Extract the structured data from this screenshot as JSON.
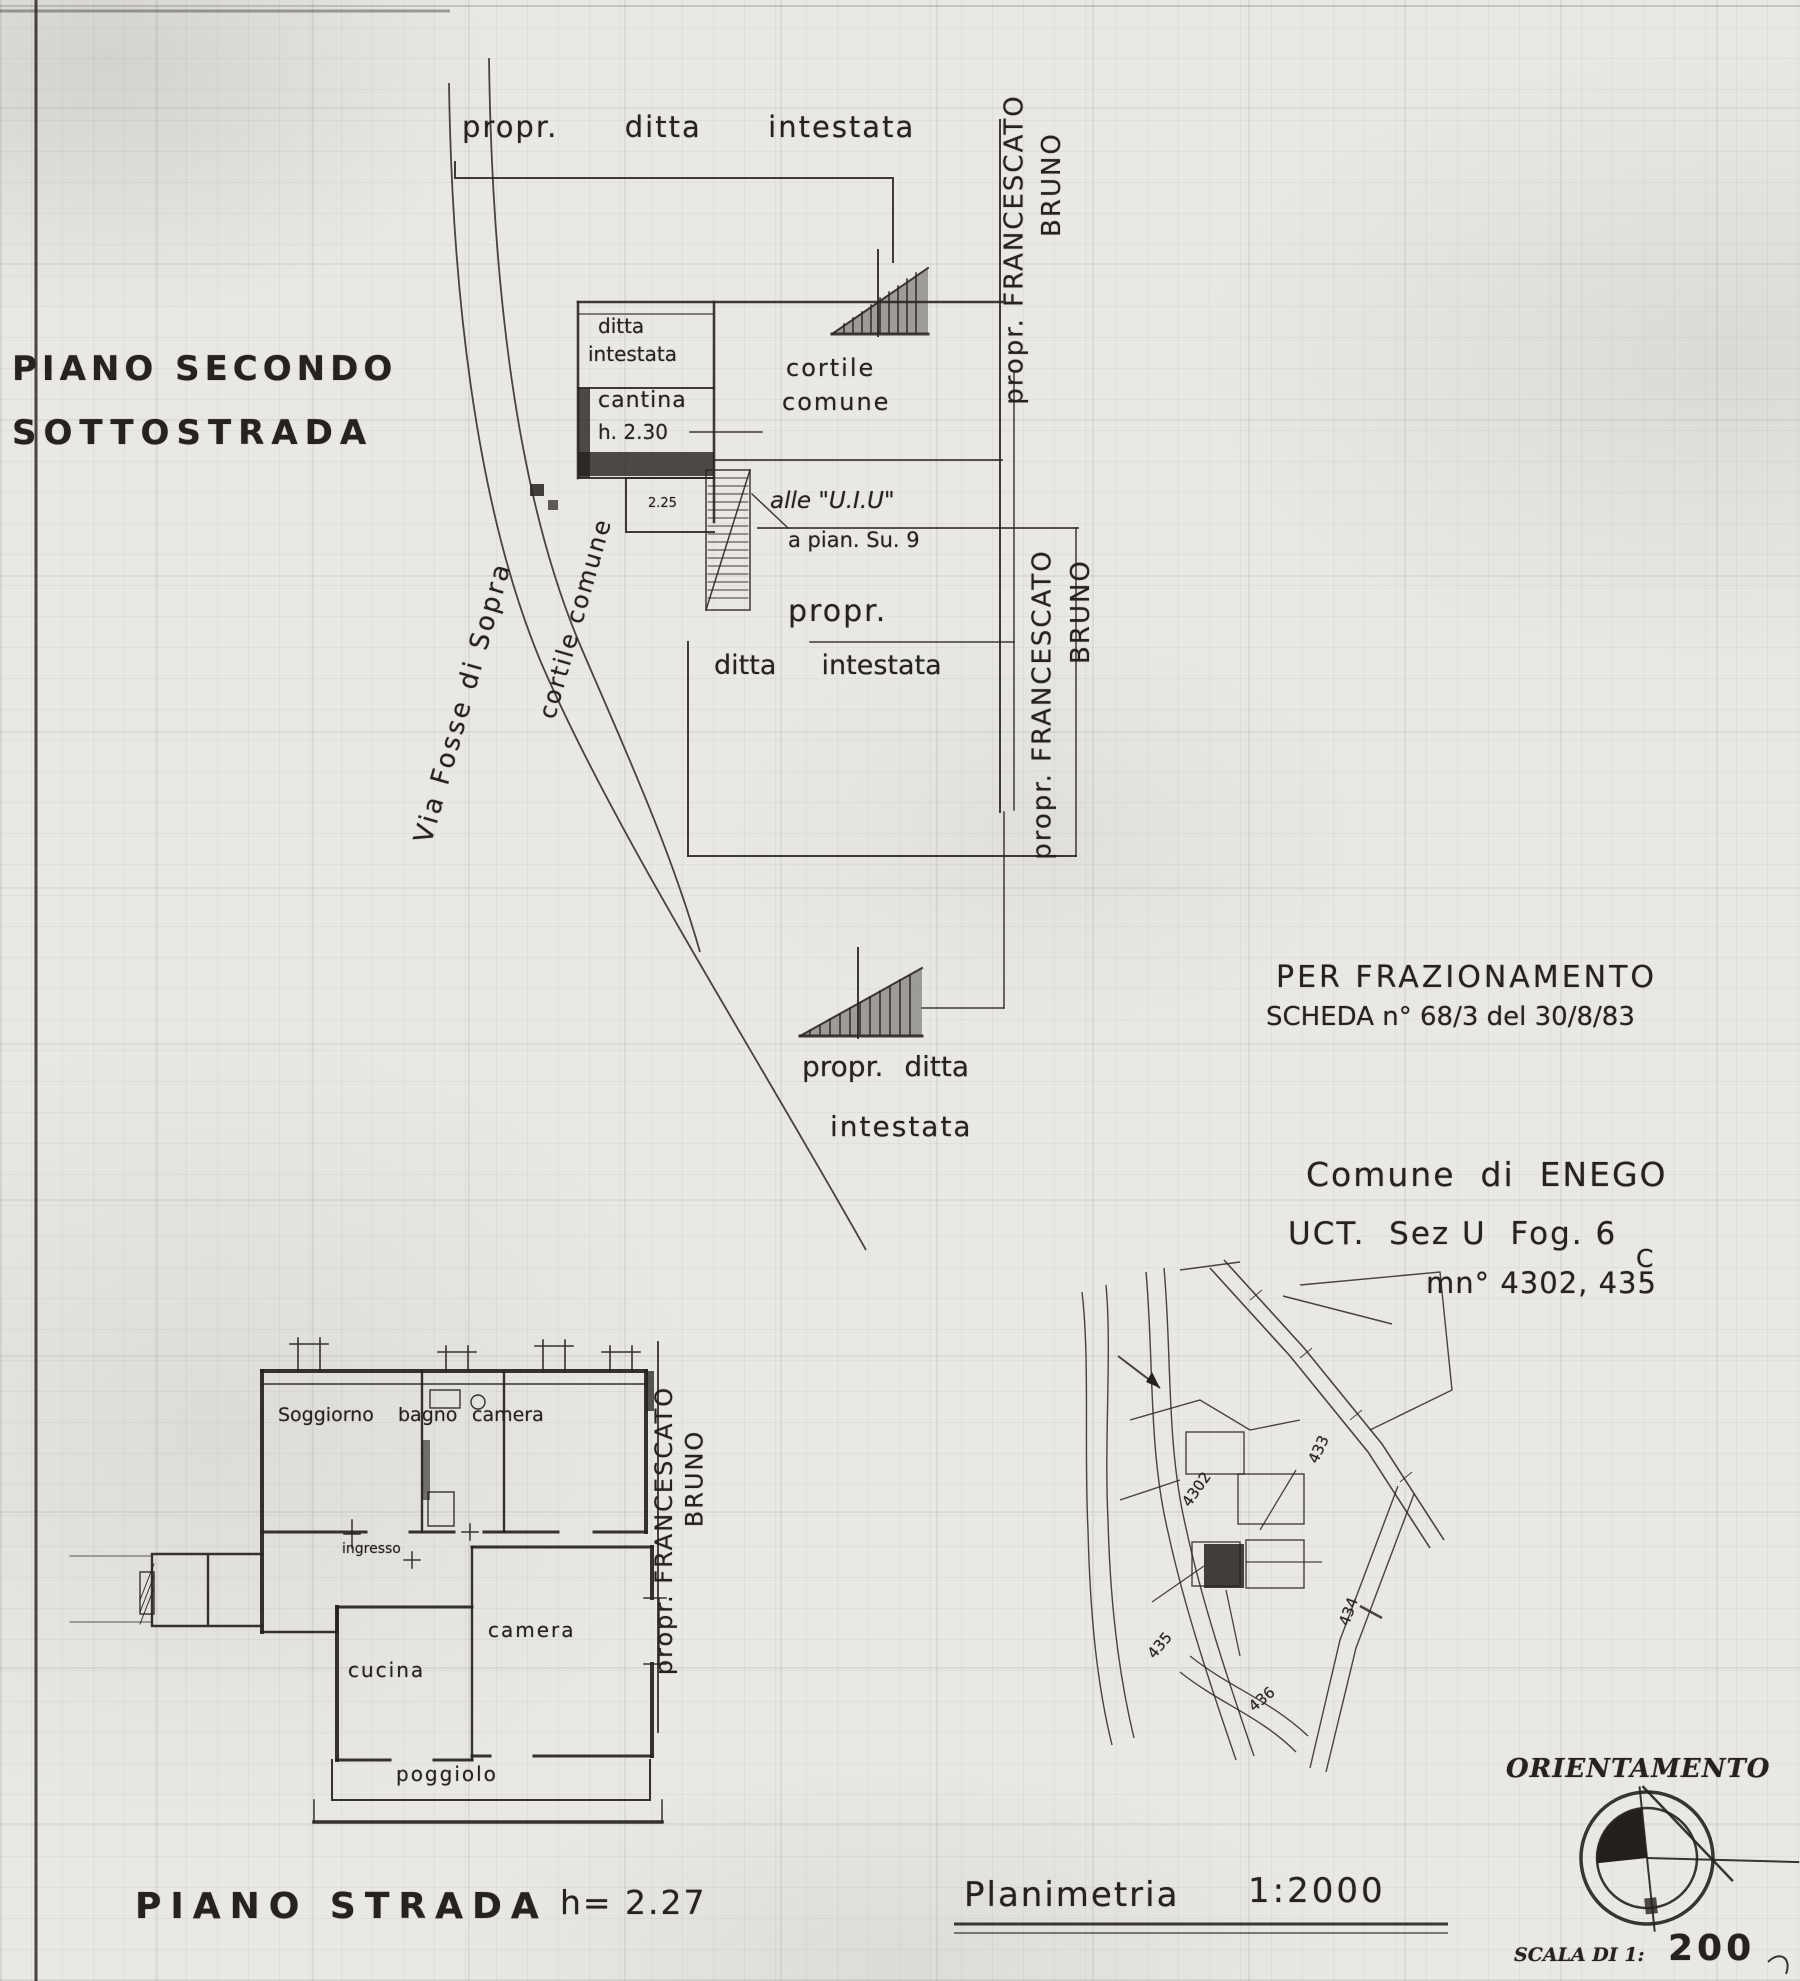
{
  "floor2": {
    "title_line1": "PIANO SECONDO",
    "title_line2": "SOTTOSTRADA",
    "owner_top": "propr.  ditta  intestata",
    "cantina_owner_line1": "ditta",
    "cantina_owner_line2": "intestata",
    "cantina_label": "cantina",
    "cantina_height": "h. 2.30",
    "passage_height": "2.25",
    "cortile_line1": "cortile",
    "cortile_line2": "comune",
    "uiu_line1": "alle \"U.I.U\"",
    "uiu_line2": "a pian. Su. 9",
    "owner_mid_line1": "propr.",
    "owner_mid_line2": "ditta  intestata",
    "owner_stairs_line1": "propr. ditta",
    "owner_stairs_line2": "intestata",
    "street": "Via Fosse di Sopra",
    "cortile_diag": "cortile comune",
    "neighbor_line1": "propr. FRANCESCATO",
    "neighbor_line2": "BRUNO"
  },
  "floor1": {
    "caption": "PIANO STRADA",
    "height": "h= 2.27",
    "rooms": {
      "soggiorno": "Soggiorno",
      "bagno": "bagno",
      "camera1": "camera",
      "ingresso": "ingresso",
      "cucina": "cucina",
      "camera2": "camera",
      "poggiolo": "poggiolo"
    },
    "neighbor_line1": "propr. FRANCESCATO",
    "neighbor_line2": "BRUNO"
  },
  "notes": {
    "fraz_line1": "PER FRAZIONAMENTO",
    "fraz_line2": "SCHEDA n° 68/3 del 30/8/83",
    "comune_line1": "Comune  di  ENEGO",
    "comune_line2": "UCT.  Sez U  Fog. 6",
    "comune_correction": "C",
    "comune_line3": "mn° 4302, 435"
  },
  "map": {
    "caption": "Planimetria",
    "scale": "1:2000",
    "parcels": [
      "4302",
      "435",
      "433",
      "434",
      "436"
    ]
  },
  "compass": {
    "title": "ORIENTAMENTO",
    "scale_prefix": "SCALA DI 1:",
    "scale_value": "200"
  }
}
